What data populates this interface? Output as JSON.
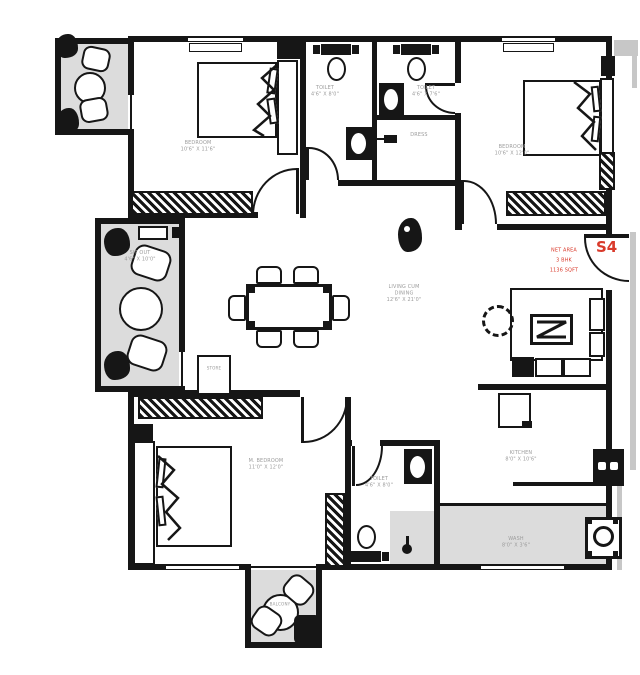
{
  "title": "Apartment floor plan - unit S4",
  "unit": {
    "label": "S4"
  },
  "area_note": {
    "line1": "NET AREA",
    "line2": "3 BHK",
    "line3": "1136 SQFT"
  },
  "rooms": {
    "bedroom_top_left": {
      "name": "BEDROOM",
      "dims": "10'6\" X 11'6\""
    },
    "toilet_top_left": {
      "name": "TOILET",
      "dims": "4'6\" X 8'0\""
    },
    "toilet_top_right": {
      "name": "TOILET",
      "dims": "4'6\" X 7'6\""
    },
    "dress": {
      "name": "DRESS"
    },
    "bedroom_top_right": {
      "name": "BEDROOM",
      "dims": "10'6\" X 12'0\""
    },
    "living": {
      "name": "LIVING CUM",
      "name2": "DINING",
      "dims": "12'6\" X 21'0\""
    },
    "sitout": {
      "name": "SIT OUT",
      "dims": "4'6\" X 10'0\""
    },
    "store": {
      "name": "STORE"
    },
    "bedroom_bottom": {
      "name": "M. BEDROOM",
      "dims": "11'0\" X 12'0\""
    },
    "toilet_bottom": {
      "name": "TOILET",
      "dims": "4'6\" X 8'0\""
    },
    "kitchen": {
      "name": "KITCHEN",
      "dims": "8'0\" X 10'6\""
    },
    "wash": {
      "name": "WASH",
      "dims": "8'0\" X 3'6\""
    },
    "balcony_bottom": {
      "name": "BALCONY"
    }
  },
  "colors": {
    "wall": "#161616",
    "balcony_fill": "#dcdcdc",
    "shadow": "#c7c7c7",
    "accent_red": "#d93a2b",
    "label": "#9b9b9b"
  }
}
